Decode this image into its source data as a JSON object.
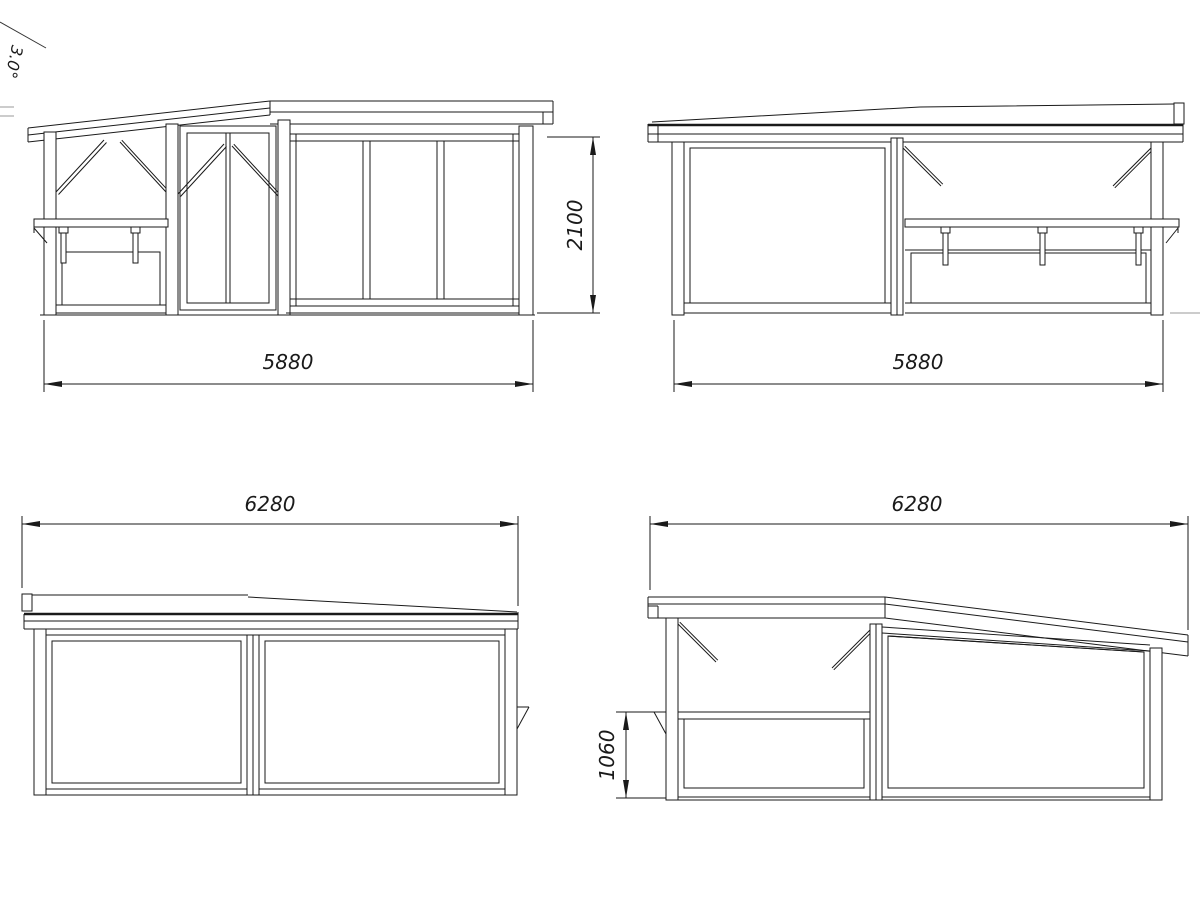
{
  "sheet": {
    "background": "#ffffff",
    "line_color": "#1a1a1a"
  },
  "annotations": {
    "roof_angle": "3.0°"
  },
  "views": {
    "front_elevation": {
      "width_dim": "5880",
      "height_dim": "2100"
    },
    "rear_elevation": {
      "width_dim": "5880"
    },
    "left_elevation": {
      "width_dim": "6280"
    },
    "right_elevation": {
      "width_dim": "6280",
      "wall_height_dim": "1060"
    }
  }
}
